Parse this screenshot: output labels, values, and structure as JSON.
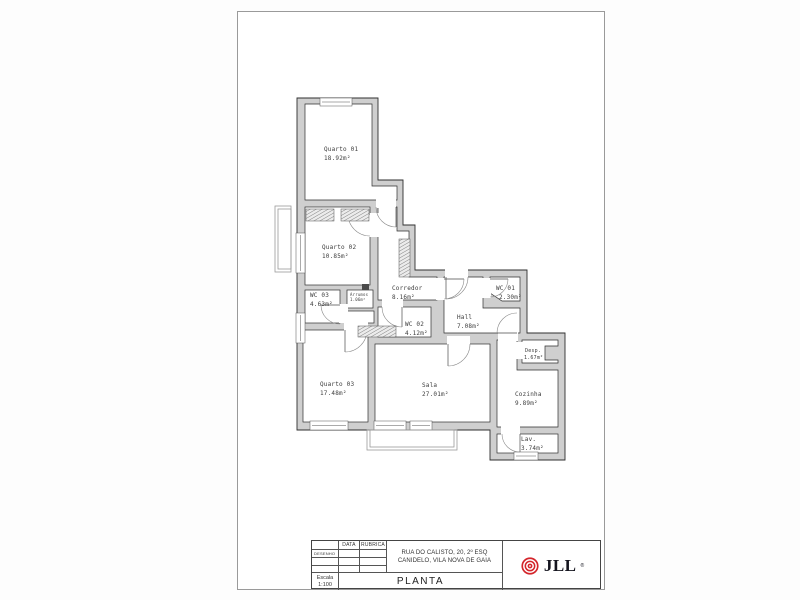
{
  "plan": {
    "rooms": [
      {
        "name": "Quarto 01",
        "area": "18.92m²"
      },
      {
        "name": "Quarto 02",
        "area": "10.85m²"
      },
      {
        "name": "WC 03",
        "area": "4.63m²"
      },
      {
        "name": "Arrumos",
        "area": "1.06m²"
      },
      {
        "name": "Corredor",
        "area": "8.16m²"
      },
      {
        "name": "WC 01",
        "area": "2.30m²"
      },
      {
        "name": "WC 02",
        "area": "4.12m²"
      },
      {
        "name": "Hall",
        "area": "7.08m²"
      },
      {
        "name": "Desp.",
        "area": "1.67m²"
      },
      {
        "name": "Quarto 03",
        "area": "17.48m²"
      },
      {
        "name": "Sala",
        "area": "27.01m²"
      },
      {
        "name": "Cozinha",
        "area": "9.89m²"
      },
      {
        "name": "Lav.",
        "area": "3.74m²"
      }
    ],
    "wall_color": "#cfcfcf"
  },
  "title_block": {
    "desenho_label": "DESENHO",
    "data_label": "DATA",
    "rubrica_label": "RUBRICA",
    "address_line1": "RUA DO CALISTO, 20, 2º ESQ",
    "address_line2": "CANIDELO, VILA NOVA DE GAIA",
    "escala_label": "Escala",
    "escala_value": "1:100",
    "drawing_title": "PLANTA",
    "logo_text": "JLL",
    "logo_reg": "®",
    "logo_color": "#d4252b"
  }
}
